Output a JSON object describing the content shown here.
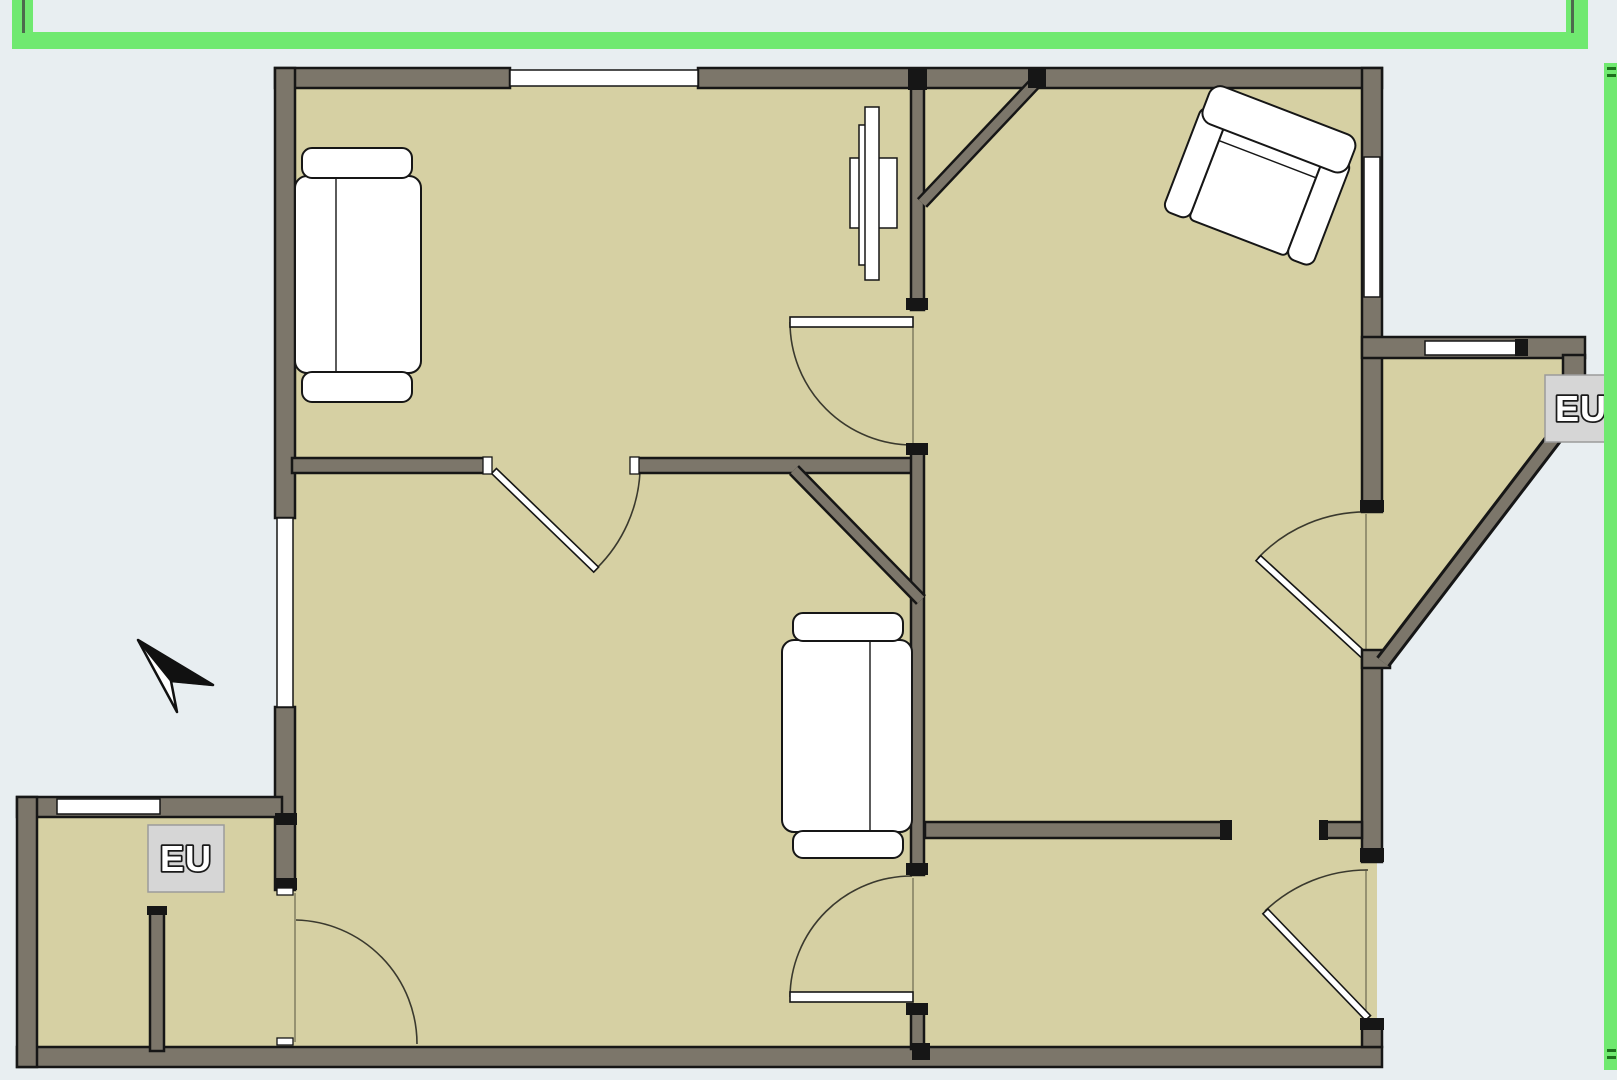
{
  "app": {
    "title": "Floor plan canvas",
    "canvas_background": "#e8eef1"
  },
  "plan": {
    "floor_color": "#d6d0a3",
    "wall_color": "#7c766a",
    "wall_outline_color": "#161616",
    "window_color": "#ffffff",
    "door_arc_color": "#3a392e",
    "selection_color": "#70e970",
    "selection_line_color": "#4d6a4d",
    "selection_tick_color": "#1c701c",
    "label_background": "#d6d6d6",
    "label_border": "#9b9b9b",
    "label_text_color": "#ffffff",
    "label_text_outline": "#1a1a1a"
  },
  "labels": {
    "entry_unit": "EU",
    "bay_unit": "EU"
  },
  "furniture": [
    {
      "name": "sofa-top-left"
    },
    {
      "name": "sofa-middle"
    },
    {
      "name": "armchair-top-right"
    },
    {
      "name": "wall-panel"
    }
  ],
  "icons": {
    "cursor": "cursor-arrow-icon"
  }
}
